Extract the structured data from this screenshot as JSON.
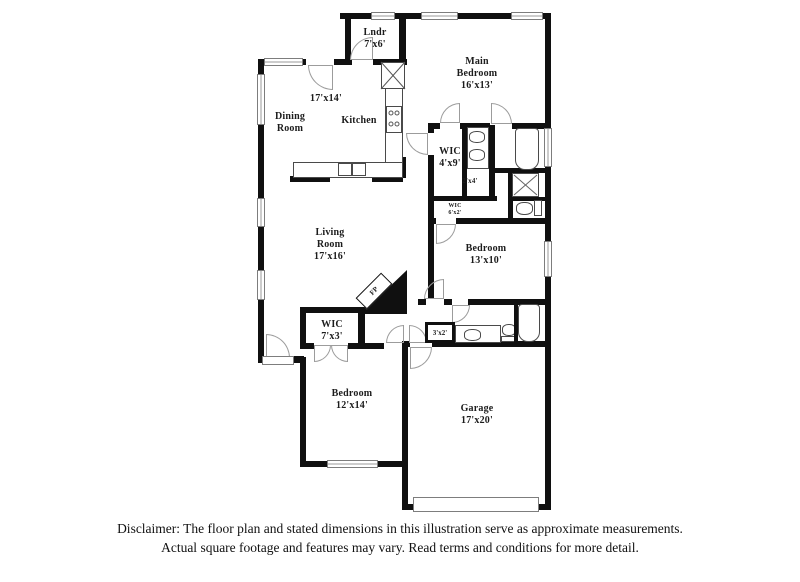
{
  "plan": {
    "labels": {
      "lndr_name": "Lndr",
      "lndr_dims": "7'x6'",
      "main_bedroom_name": "Main Bedroom",
      "main_bedroom_dims": "16'x13'",
      "dining_kitchen_dims": "17'x14'",
      "dining_name": "Dining Room",
      "kitchen_name": "Kitchen",
      "wic_main_name": "WIC",
      "wic_main_dims": "4'x9'",
      "nook_dims": "2'x4'",
      "wic_small_name": "WIC",
      "wic_small_dims": "6'x2'",
      "bedroom2_name": "Bedroom",
      "bedroom2_dims": "13'x10'",
      "living_name": "Living Room",
      "living_dims": "17'x16'",
      "fireplace_label": "FP",
      "wic3_name": "WIC",
      "wic3_dims": "7'x3'",
      "hall_closet_dims": "3'x2'",
      "bedroom3_name": "Bedroom",
      "bedroom3_dims": "12'x14'",
      "garage_name": "Garage",
      "garage_dims": "17'x20'"
    },
    "disclaimer": {
      "line1": "Disclaimer: The floor plan and stated dimensions in this illustration serve as approximate measurements.",
      "line2": "Actual square footage and features may vary. Read terms and conditions for more detail."
    }
  }
}
